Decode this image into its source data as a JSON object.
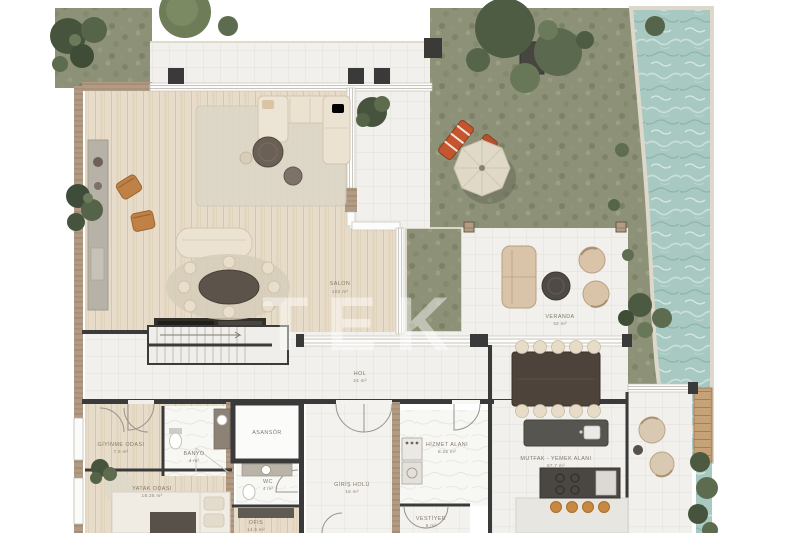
{
  "watermark": "TEK",
  "palette": {
    "lawn": "#8c9177",
    "water": "#a7c9c1",
    "wood_floor": "#e7dcc9",
    "tile": "#f1f0ec",
    "wall_dark": "#3a3a3a",
    "wall_wood": "#b29b85",
    "furniture_cream": "#ebe2d2",
    "accent_orange": "#c08147"
  },
  "rooms": [
    {
      "name": "SALON",
      "area": "102 m²"
    },
    {
      "name": "VERANDA",
      "area": "42 m²"
    },
    {
      "name": "HOL",
      "area": "24 m²"
    },
    {
      "name": "GİYİNME ODASI",
      "area": "7.5 m²"
    },
    {
      "name": "BANYO",
      "area": "4 m²"
    },
    {
      "name": "YATAK ODASI",
      "area": "18.25 m²"
    },
    {
      "name": "ASANSÖR",
      "area": ""
    },
    {
      "name": "WC",
      "area": "4 m²"
    },
    {
      "name": "OFİS",
      "area": "14.5 m²"
    },
    {
      "name": "GİRİŞ HOLÜ",
      "area": "16 m²"
    },
    {
      "name": "HİZMET ALANI",
      "area": "8.25 m²"
    },
    {
      "name": "MUTFAK - YEMEK ALANI",
      "area": "67.7 m²"
    },
    {
      "name": "VESTİYER",
      "area": "5 m²"
    }
  ]
}
